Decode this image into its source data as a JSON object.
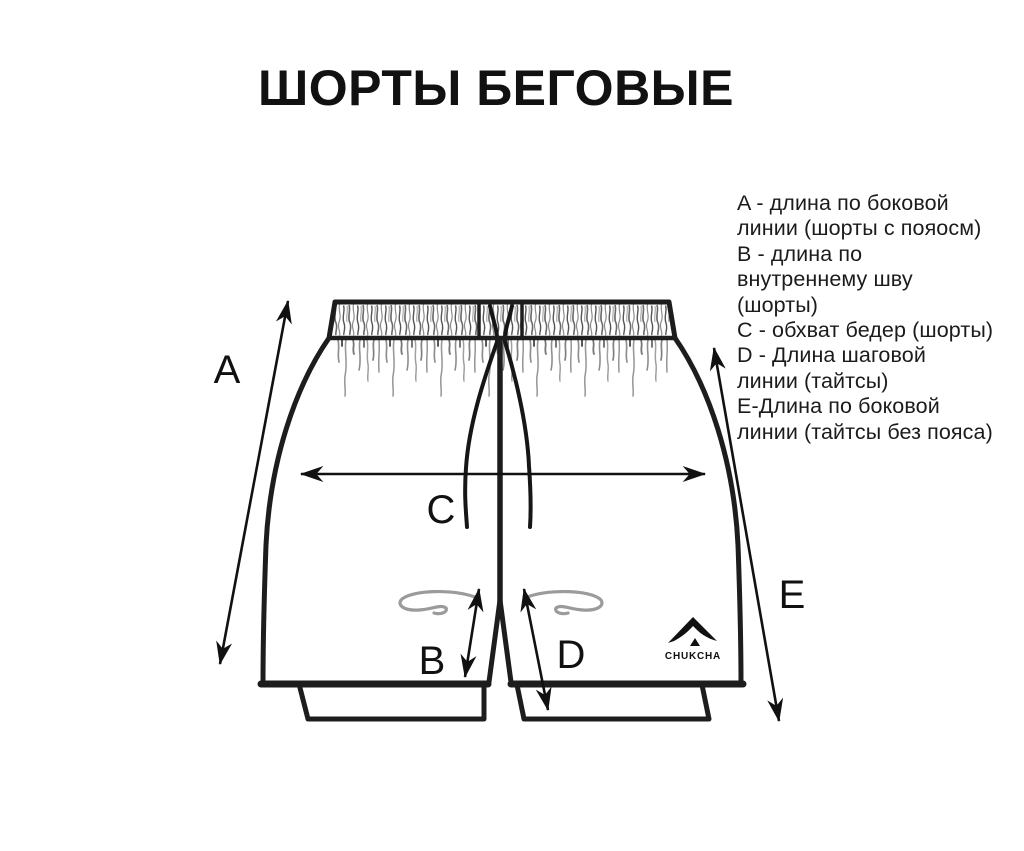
{
  "title": "ШОРТЫ БЕГОВЫЕ",
  "colors": {
    "ink": "#111111",
    "outline": "#1d1d1d",
    "detail_gray": "#9b9b9b",
    "background": "#ffffff"
  },
  "legend": {
    "lines": [
      "A - длина по боковой",
      "линии (шорты с пояосм)",
      "B - длина по",
      "внутреннему шву",
      "(шорты)",
      "C - обхват бедер (шорты)",
      "D - Длина шаговой",
      "линии (тайтсы)",
      "E-Длина по боковой",
      "линии (тайтсы без пояса)"
    ]
  },
  "diagram": {
    "measure_labels": {
      "a": "A",
      "b": "B",
      "c": "C",
      "d": "D",
      "e": "E"
    },
    "logo_text": "CHUKCHA"
  }
}
